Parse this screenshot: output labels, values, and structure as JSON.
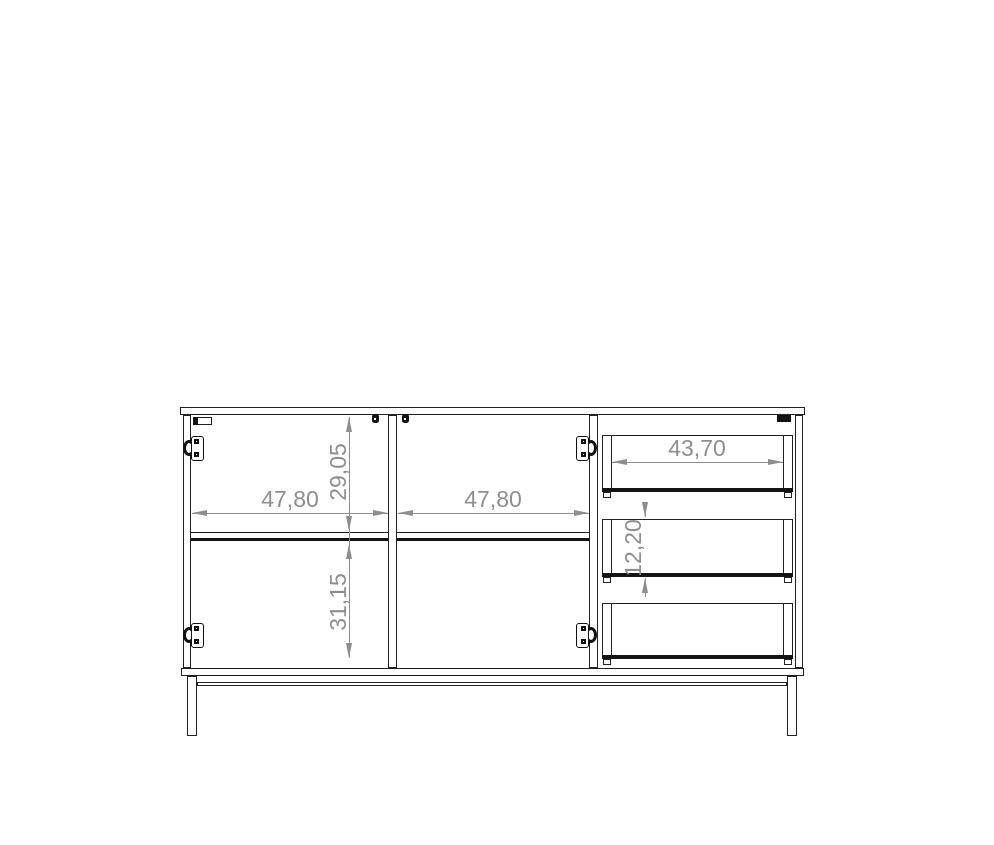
{
  "drawing": {
    "type": "furniture-technical-drawing",
    "subject": "sideboard front view with two doors, internal shelf, three drawers and metal leg frame",
    "labels": {
      "left_door_width": "47,80",
      "right_door_width": "47,80",
      "top_section_height": "29,05",
      "bottom_section_height": "31,15",
      "drawer_inner_width": "43,70",
      "drawer_front_height": "12,20"
    },
    "colors": {
      "line": "#222222",
      "thick_line": "#141414",
      "dimension": "#8e8e8e",
      "background": "#ffffff"
    }
  }
}
